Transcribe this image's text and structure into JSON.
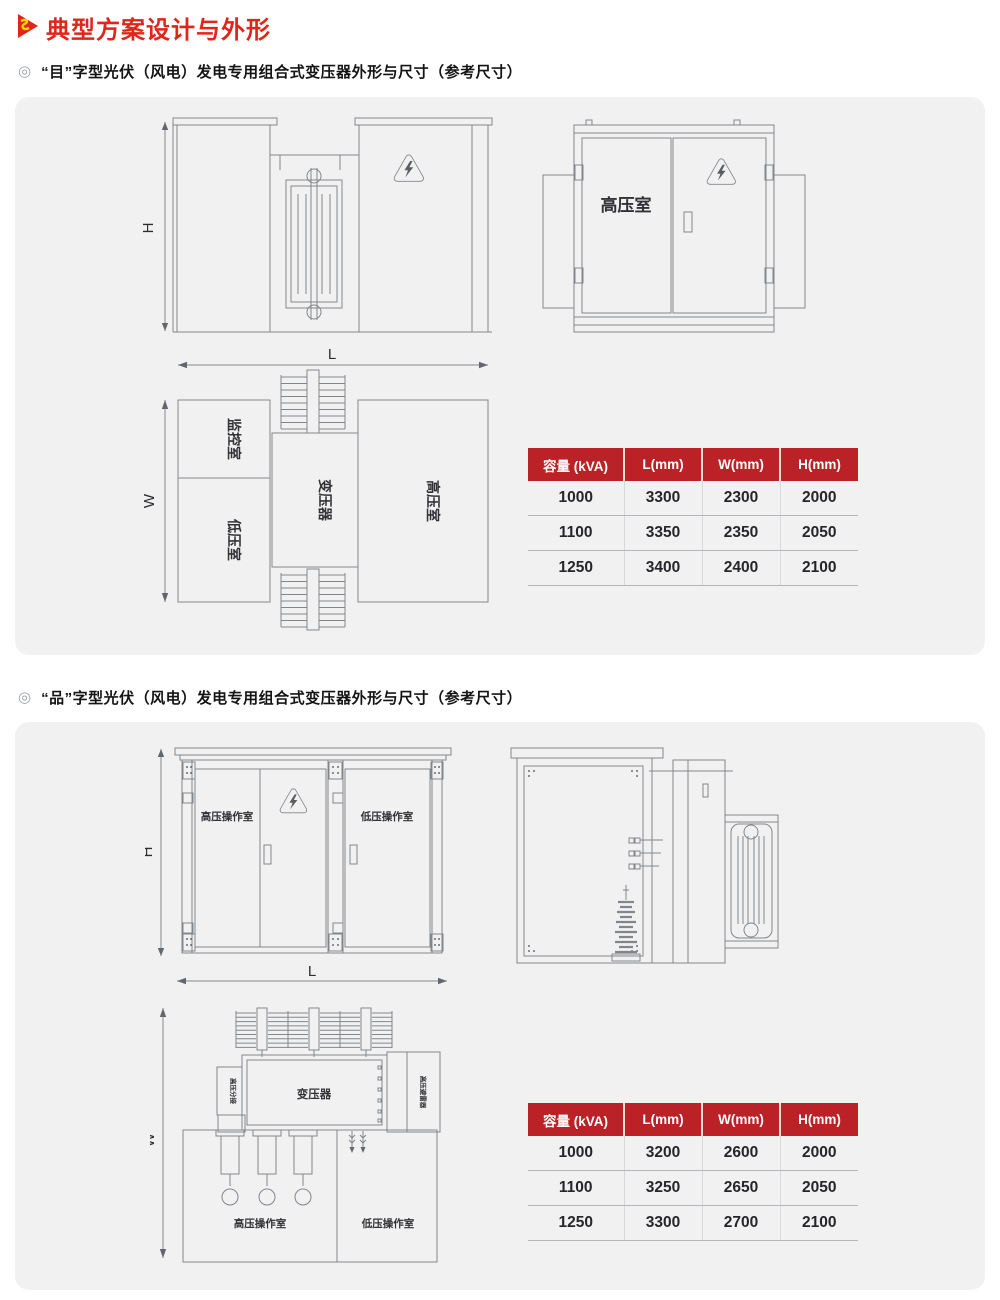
{
  "page": {
    "title": "典型方案设计与外形",
    "bullet": "◎"
  },
  "sections": [
    {
      "title": "“目”字型光伏（风电）发电专用组合式变压器外形与尺寸（参考尺寸）"
    },
    {
      "title": "“品”字型光伏（风电）发电专用组合式变压器外形与尺寸（参考尺寸）"
    }
  ],
  "dims": {
    "h": "H",
    "l": "L",
    "w": "W"
  },
  "diagram1": {
    "door_label": "高压室",
    "top_view": {
      "monitor_room": "监控室",
      "lv_room": "低压室",
      "transformer": "变压器",
      "hv_room": "高压室"
    }
  },
  "diagram2": {
    "front": {
      "hv_op_room": "高压操作室",
      "lv_op_room": "低压操作室"
    },
    "top_view": {
      "transformer": "变压器",
      "left_side_label": "高压分接",
      "right_side_label": "高压避雷器",
      "hv_op_room": "高压操作室",
      "lv_op_room": "低压操作室"
    }
  },
  "table1": {
    "headers": [
      "容量 (kVA)",
      "L(mm)",
      "W(mm)",
      "H(mm)"
    ],
    "rows": [
      [
        "1000",
        "3300",
        "2300",
        "2000"
      ],
      [
        "1100",
        "3350",
        "2350",
        "2050"
      ],
      [
        "1250",
        "3400",
        "2400",
        "2100"
      ]
    ]
  },
  "table2": {
    "headers": [
      "容量 (kVA)",
      "L(mm)",
      "W(mm)",
      "H(mm)"
    ],
    "rows": [
      [
        "1000",
        "3200",
        "2600",
        "2000"
      ],
      [
        "1100",
        "3250",
        "2650",
        "2050"
      ],
      [
        "1250",
        "3300",
        "2700",
        "2100"
      ]
    ]
  },
  "colors": {
    "accent_red": "#e0251b",
    "table_header_red": "#bb2227",
    "panel_bg": "#f1f1f2",
    "line_gray": "#82868b"
  }
}
